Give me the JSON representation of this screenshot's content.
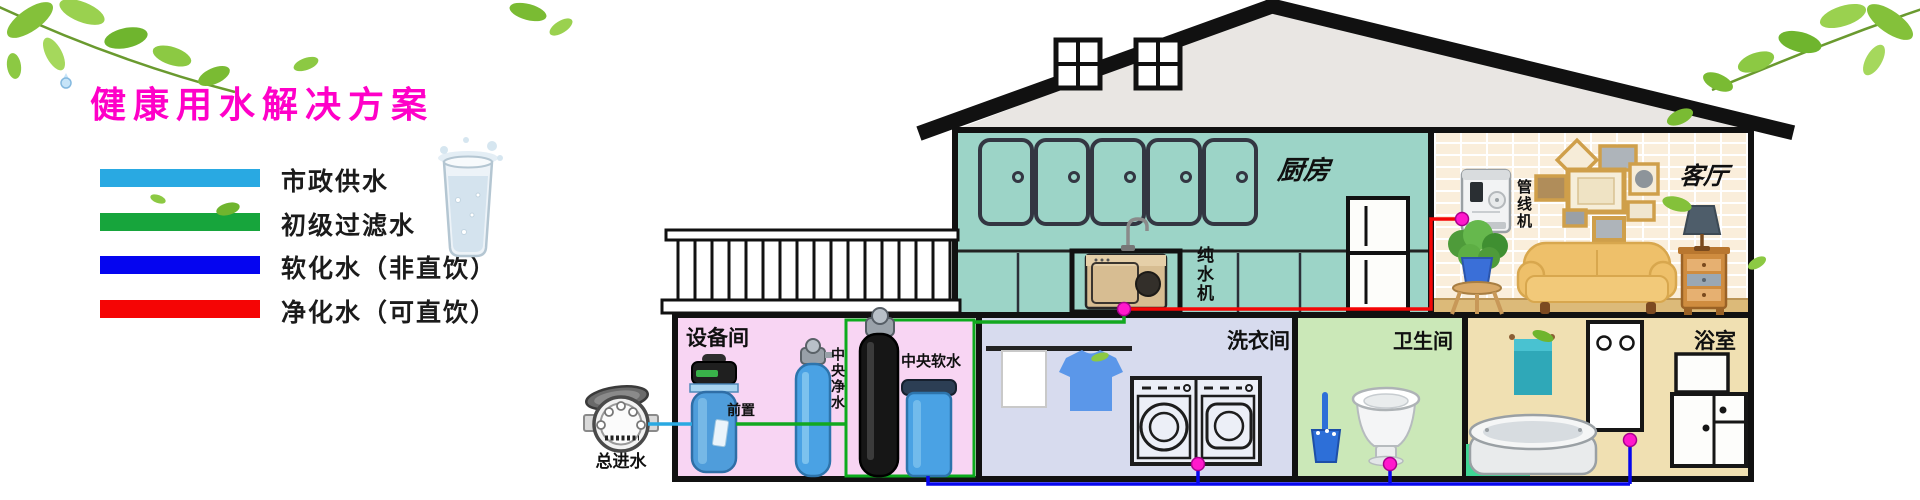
{
  "title": {
    "text": "健康用水解决方案"
  },
  "legend": {
    "items": [
      {
        "label": "市政供水",
        "color": "#29a9e2"
      },
      {
        "label": "初级过滤水",
        "color": "#17a53c"
      },
      {
        "label": "软化水（非直饮）",
        "color": "#0505f0"
      },
      {
        "label": "净化水（可直饮）",
        "color": "#f50505"
      }
    ]
  },
  "rooms": {
    "kitchen": "厨房",
    "living_room": "客厅",
    "equipment_room": "设备间",
    "laundry_room": "洗衣间",
    "toilet": "卫生间",
    "bathroom": "浴室"
  },
  "devices": {
    "main_inlet": "总进水",
    "prefilter": "前置",
    "central_purifier": "中央净水",
    "central_softener": "中央软水",
    "pure_water_machine": "纯水机",
    "pipeline_machine": "管线机"
  },
  "colors": {
    "municipal_pipe": "#29a9e2",
    "filtered_pipe": "#12a81f",
    "softened_pipe": "#0707ee",
    "purified_pipe": "#f40606",
    "junction_dot": "#ff19cc",
    "highlight_box": "#0cab1d"
  }
}
